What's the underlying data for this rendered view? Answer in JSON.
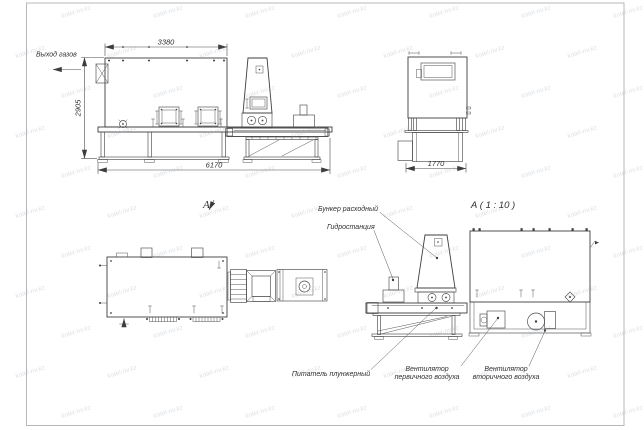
{
  "sheet": {
    "watermark_text": "kotel-nv.kz"
  },
  "side_view": {
    "label_gas_outlet": "Выход газов",
    "dim_top": "3380",
    "dim_left": "2905",
    "dim_bottom": "6170"
  },
  "end_view": {
    "dim_bottom": "1770"
  },
  "top_view": {
    "view_label": "А"
  },
  "detail_view": {
    "title": "А ( 1 : 10 )",
    "label_hopper": "Бункер расходный",
    "label_hydrostation": "Гидростанция",
    "label_feeder": "Питатель плунжерный",
    "label_fan_primary_line1": "Вентилятор",
    "label_fan_primary_line2": "первичного воздуха",
    "label_fan_secondary_line1": "Вентилятор",
    "label_fan_secondary_line2": "вторичного воздуха"
  },
  "colors": {
    "line": "#3d3d3d",
    "dim": "#4a4a4a",
    "watermark": "#9aa8b6",
    "sheet": "#ffffff"
  }
}
